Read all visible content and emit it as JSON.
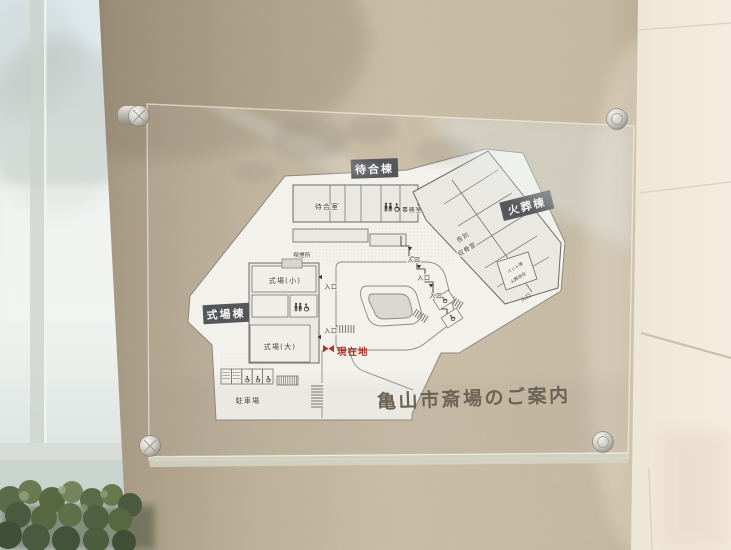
{
  "sign": {
    "title": "亀山市斎場のご案内",
    "map": {
      "building_labels": {
        "waiting": "待合棟",
        "cremation": "火葬棟",
        "ceremony": "式場棟"
      },
      "rooms": {
        "waiting_room": "待合室",
        "office": "事務室",
        "farewell_line1": "告別",
        "farewell_line2": "収骨室",
        "hall_small": "式場(小)",
        "hall_large": "式場(大)",
        "pet_line1": "ペット等",
        "pet_line2": "火葬待合",
        "smoking_area": "喫煙所",
        "parking": "駐車場"
      },
      "markers": {
        "entrance": "入口",
        "current_location": "現在地"
      },
      "colors": {
        "current_location_red": "#b13227",
        "label_box": "#54565a",
        "map_paper": "#f2f1ec",
        "accent_outline": "#76746b"
      }
    }
  }
}
